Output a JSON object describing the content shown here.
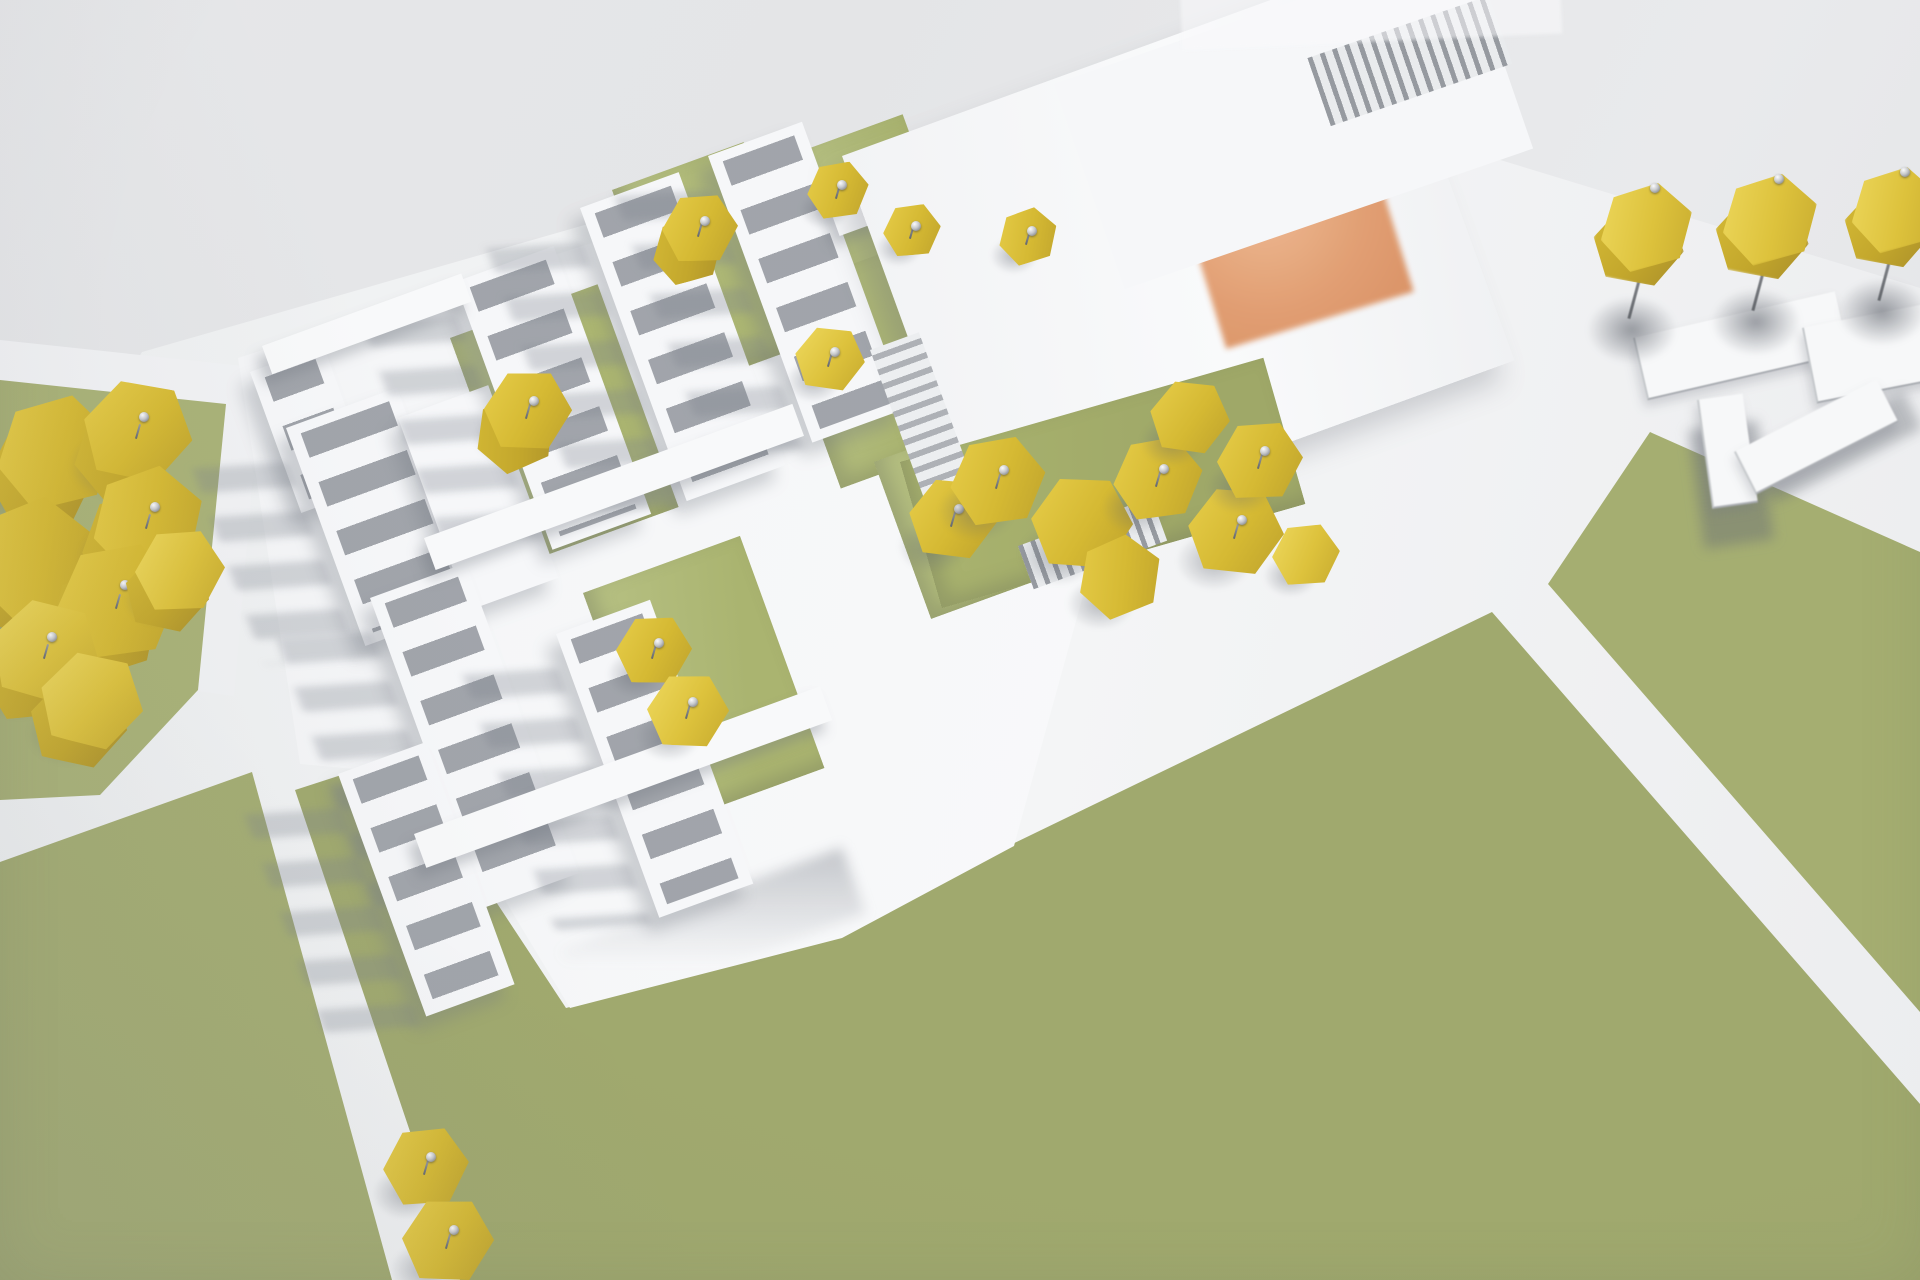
{
  "scene": {
    "title": "Aerial photograph of a white architectural massing model with olive-green paper lawns, yellow hexagonal pin trees and an orange rooftop skylight",
    "palette": {
      "background_gray": "#e6e7e9",
      "ground_white": "#f1f2f4",
      "building_white": "#f6f7f9",
      "window_recess_gray": "#9296a0",
      "lawn_green": "#a6af73",
      "courtyard_green": "#b3bd80",
      "tree_yellow": "#d5b933",
      "skylight_orange": "#e09a6c",
      "pin_silver": "#c7c9cc",
      "shadow_gray": "#74788a"
    },
    "rotation_deg": -20,
    "ground_white_poly": "polygon(0px 735px,0px 588px,142px 352px,1062px 88px,1238px 80px,1920px 288px,1920px 1280px,0px 1280px)",
    "left_pad_poly": "polygon(0px 340px,262px 368px,234px 696px,0px 664px)",
    "plinth_poly": "polygon(238px 358px,1068px 88px,1178px 252px,1014px 846px,842px 938px,570px 1008px,430px 776px,300px 764px)",
    "green_fields": [
      {
        "name": "lawn-left-strip",
        "color": "#a9b277",
        "poly": "polygon(0px 380px,226px 404px,198px 690px,100px 795px,0px 800px)"
      },
      {
        "name": "lawn-bottom-left",
        "color": "#a4ad72",
        "poly": "polygon(0px 862px,252px 772px,392px 1280px,0px 1280px)"
      },
      {
        "name": "lawn-bottom-center",
        "color": "#a0a96e",
        "poly": "polygon(295px 790px,400px 756px,566px 1008px,840px 936px,1004px 848px,1492px 612px,1920px 1104px,1920px 1280px,460px 1280px)"
      },
      {
        "name": "lawn-right",
        "color": "#a5ae71",
        "poly": "polygon(1650px 432px,1920px 552px,1920px 1012px,1548px 584px)"
      }
    ],
    "courtyards": [
      {
        "x": 612,
        "y": 190,
        "w": 140,
        "h": 212,
        "rot": -20
      },
      {
        "x": 788,
        "y": 156,
        "w": 122,
        "h": 176,
        "rot": -20
      },
      {
        "x": 970,
        "y": 188,
        "w": 127,
        "h": 157,
        "rot": -20
      },
      {
        "x": 450,
        "y": 338,
        "w": 157,
        "h": 237,
        "rot": -20
      },
      {
        "x": 770,
        "y": 294,
        "w": 137,
        "h": 207,
        "rot": -20
      },
      {
        "x": 583,
        "y": 593,
        "w": 167,
        "h": 247,
        "rot": -20
      },
      {
        "x": 874,
        "y": 462,
        "w": 137,
        "h": 167,
        "rot": -20
      },
      {
        "x": 900,
        "y": 462,
        "w": 378,
        "h": 152,
        "rot": -16
      }
    ],
    "slabs": [
      {
        "x": 250,
        "y": 372,
        "w": 78,
        "h": 150,
        "win": true
      },
      {
        "x": 286,
        "y": 428,
        "w": 118,
        "h": 232,
        "win": true,
        "streak": true
      },
      {
        "x": 398,
        "y": 418,
        "w": 96,
        "h": 205,
        "win": false
      },
      {
        "x": 455,
        "y": 282,
        "w": 105,
        "h": 285,
        "win": true,
        "streak": true
      },
      {
        "x": 580,
        "y": 208,
        "w": 105,
        "h": 312,
        "win": true,
        "streak": true
      },
      {
        "x": 708,
        "y": 156,
        "w": 100,
        "h": 305,
        "win": true,
        "streak": true
      },
      {
        "x": 928,
        "y": 156,
        "w": 90,
        "h": 152,
        "win": true
      },
      {
        "x": 370,
        "y": 598,
        "w": 102,
        "h": 330,
        "win": true,
        "streak": true
      },
      {
        "x": 556,
        "y": 634,
        "w": 100,
        "h": 302,
        "win": true,
        "streak": true
      },
      {
        "x": 338,
        "y": 774,
        "w": 94,
        "h": 258,
        "win": true,
        "streak": true
      }
    ],
    "bars": [
      {
        "x": 262,
        "y": 346,
        "w": 212,
        "h": 30
      },
      {
        "x": 424,
        "y": 538,
        "w": 392,
        "h": 34
      },
      {
        "x": 414,
        "y": 834,
        "w": 432,
        "h": 36
      },
      {
        "x": 828,
        "y": 204,
        "w": 242,
        "h": 34
      }
    ],
    "hall": {
      "x": 842,
      "y": 156,
      "w": 562,
      "h": 422,
      "rot": -20,
      "orange": {
        "x": 300,
        "y": 128,
        "w": 196,
        "h": 190
      }
    },
    "top_slab": {
      "x": 1054,
      "y": 84,
      "w": 432,
      "h": 217,
      "rot": -19,
      "louver": {
        "x": 248,
        "y": 58,
        "w": 192,
        "h": 72
      }
    },
    "louver_wall": {
      "x": 870,
      "y": 350,
      "w": 52,
      "h": 207,
      "rot": -20
    },
    "colonnade": {
      "x": 1018,
      "y": 546,
      "w": 142,
      "h": 46,
      "rot": -20
    },
    "soft_wedges": [
      {
        "x": 1140,
        "y": 170,
        "w": 360,
        "h": 80,
        "rot": -19
      },
      {
        "x": 560,
        "y": 950,
        "w": 300,
        "h": 70,
        "rot": -20
      }
    ],
    "trees_courtyard": [
      {
        "x": 700,
        "y": 228,
        "s": 76,
        "pin": true,
        "double": true
      },
      {
        "x": 838,
        "y": 190,
        "s": 62,
        "pin": true
      },
      {
        "x": 912,
        "y": 230,
        "s": 58,
        "pin": true
      },
      {
        "x": 1028,
        "y": 236,
        "s": 60,
        "pin": true
      },
      {
        "x": 830,
        "y": 358,
        "s": 70,
        "pin": true
      },
      {
        "x": 528,
        "y": 410,
        "s": 88,
        "pin": true,
        "double": true
      },
      {
        "x": 654,
        "y": 650,
        "s": 76,
        "pin": true
      },
      {
        "x": 688,
        "y": 710,
        "s": 82,
        "pin": true
      },
      {
        "x": 953,
        "y": 518,
        "s": 88,
        "pin": true
      }
    ],
    "trees_right_cluster": [
      {
        "x": 998,
        "y": 480,
        "s": 96,
        "pin": true
      },
      {
        "x": 1082,
        "y": 522,
        "s": 102
      },
      {
        "x": 1158,
        "y": 478,
        "s": 90,
        "pin": true
      },
      {
        "x": 1236,
        "y": 530,
        "s": 96,
        "pin": true
      },
      {
        "x": 1120,
        "y": 576,
        "s": 86
      },
      {
        "x": 1190,
        "y": 416,
        "s": 80
      },
      {
        "x": 1260,
        "y": 460,
        "s": 86,
        "pin": true
      },
      {
        "x": 1306,
        "y": 554,
        "s": 68
      }
    ],
    "trees_left_cluster": [
      {
        "x": 56,
        "y": 452,
        "s": 120
      },
      {
        "x": 138,
        "y": 430,
        "s": 110,
        "pin": true
      },
      {
        "x": 34,
        "y": 558,
        "s": 128
      },
      {
        "x": 148,
        "y": 520,
        "s": 114,
        "pin": true
      },
      {
        "x": 118,
        "y": 600,
        "s": 124,
        "pin": true
      },
      {
        "x": 46,
        "y": 650,
        "s": 110,
        "pin": true
      },
      {
        "x": 180,
        "y": 570,
        "s": 90
      },
      {
        "x": 92,
        "y": 700,
        "s": 104
      }
    ],
    "trees_bottom": [
      {
        "x": 426,
        "y": 1166,
        "s": 86,
        "pin": true
      },
      {
        "x": 448,
        "y": 1240,
        "s": 92,
        "pin": true
      }
    ],
    "lollipop_trees": [
      {
        "x": 1646,
        "y": 230,
        "s": 95
      },
      {
        "x": 1770,
        "y": 222,
        "s": 98
      },
      {
        "x": 1896,
        "y": 212,
        "s": 92
      }
    ],
    "sheets": [
      {
        "x": 1633,
        "y": 338,
        "w": 205,
        "h": 62,
        "rot": -13
      },
      {
        "x": 1802,
        "y": 328,
        "w": 155,
        "h": 75,
        "rot": -11
      }
    ],
    "ramp": {
      "shadow1": {
        "x": 1688,
        "y": 430,
        "w": 70,
        "h": 120,
        "rot": -8
      },
      "shadow2": {
        "x": 1756,
        "y": 466,
        "w": 165,
        "h": 42,
        "rot": -27
      },
      "pieceA": {
        "x": 1697,
        "y": 400,
        "w": 44,
        "h": 108,
        "rot": -8
      },
      "pieceB": {
        "x": 1734,
        "y": 452,
        "w": 158,
        "h": 46,
        "rot": -27
      }
    },
    "top_strip": {
      "x": 1180,
      "y": -8,
      "w": 380,
      "h": 58,
      "rot": -2.5
    }
  }
}
